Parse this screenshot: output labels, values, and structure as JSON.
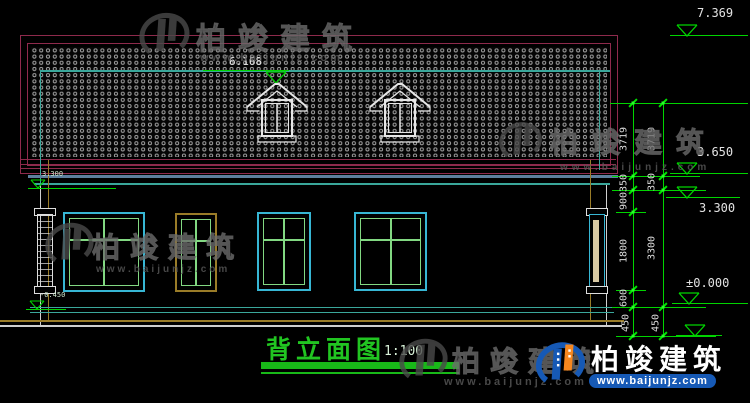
{
  "drawing": {
    "title": "背立面图",
    "scale": "1:100"
  },
  "elevations": {
    "roof_top": "7.369",
    "ridge": "6.168",
    "eave": "3.650",
    "floor2_right": "3.300",
    "ground_zero": "±0.000",
    "eave_left": "3.300",
    "ground_left": "-0.450"
  },
  "dimension_chains": {
    "inner": [
      "3719",
      "350",
      "900",
      "1800",
      "600",
      "450"
    ],
    "outer": [
      "3719",
      "350",
      "3300",
      "450"
    ]
  },
  "watermark": {
    "brand": "柏竣建筑",
    "url": "www.baijunjz.com"
  },
  "logo": {
    "brand": "柏竣建筑",
    "url": "www.baijunjz.com"
  },
  "colors": {
    "roof_border": "#8e2a4c",
    "teal": "#3aa79b",
    "dim_green": "#00d400",
    "window_cyan": "#37b6d4",
    "window_green": "#82d882",
    "olive": "#9a7c28",
    "steel_blue": "#5d7f9e",
    "title_green": "#21c521",
    "logo_blue": "#1659b5",
    "logo_orange": "#f5871f"
  }
}
